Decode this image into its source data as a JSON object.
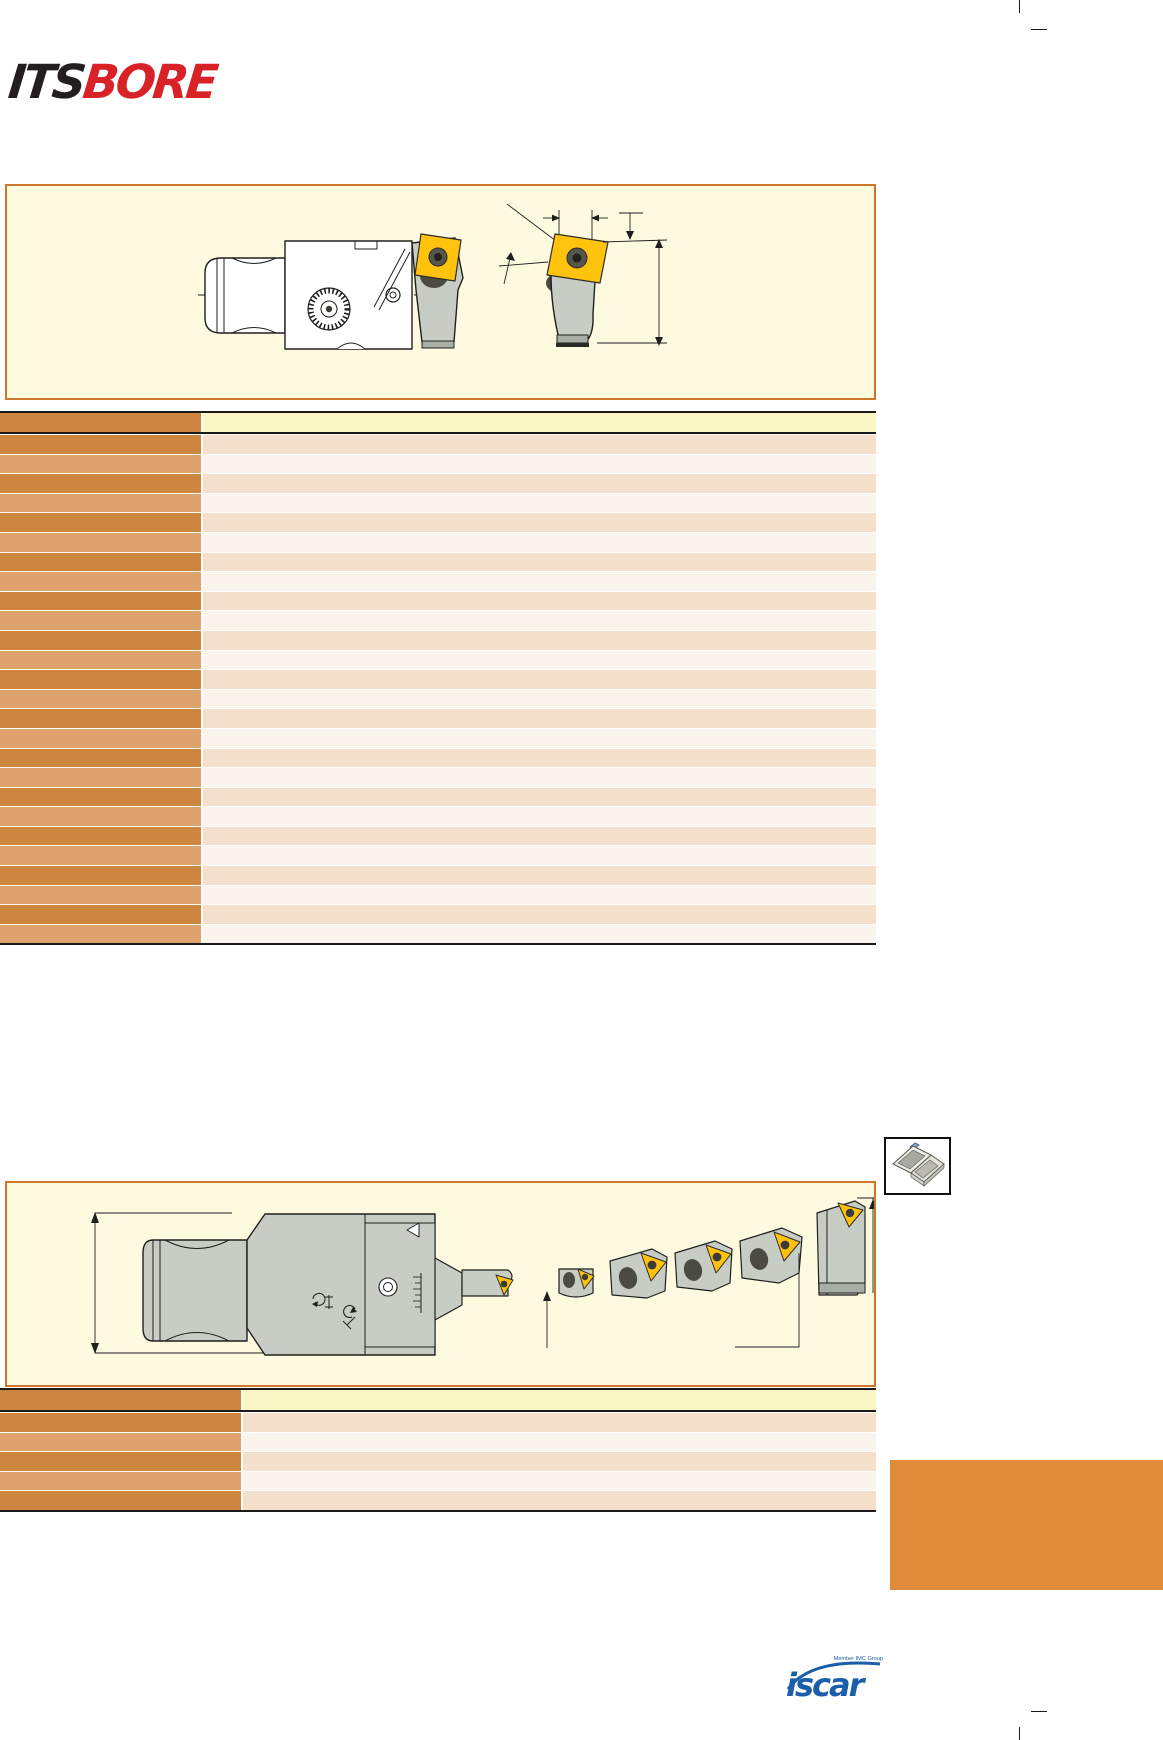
{
  "brand": {
    "logo_black": "ITS",
    "logo_red": "BORE"
  },
  "footer": {
    "member_text": "Member IMC Group",
    "logo_text": "iscar"
  },
  "tables": {
    "cartridge_table": {
      "left_col_width": 201,
      "header_height": 19,
      "row_count": 26,
      "row_height": 18.6,
      "cells_blank": true
    },
    "head_table": {
      "left_col_width": 241,
      "header_height": 20,
      "row_count": 5,
      "row_height": 18.6,
      "cells_blank": true
    }
  },
  "icons": {
    "insert_case_icon": "open-insert-case",
    "crop_marks": "print-registration-lines"
  },
  "colors": {
    "panel_bg": "#FDFAE0",
    "panel_border": "#CE772B",
    "header_left": "#CE8540",
    "header_right": "#FBF7C5",
    "row_dark_left": "#CE8540",
    "row_light_left": "#DDA26E",
    "row_dark_right": "#F4E0CC",
    "row_light_right": "#FBF4ED",
    "table_border": "#1A1A1A",
    "brand_black": "#231F20",
    "brand_red": "#D92128",
    "iscar_blue": "#1B5EA9",
    "accent_block": "#E08B39",
    "insert_yellow": "#FFC20D",
    "drawing_gray": "#C7CDC5",
    "drawing_gray_dark": "#A9AFA7"
  }
}
